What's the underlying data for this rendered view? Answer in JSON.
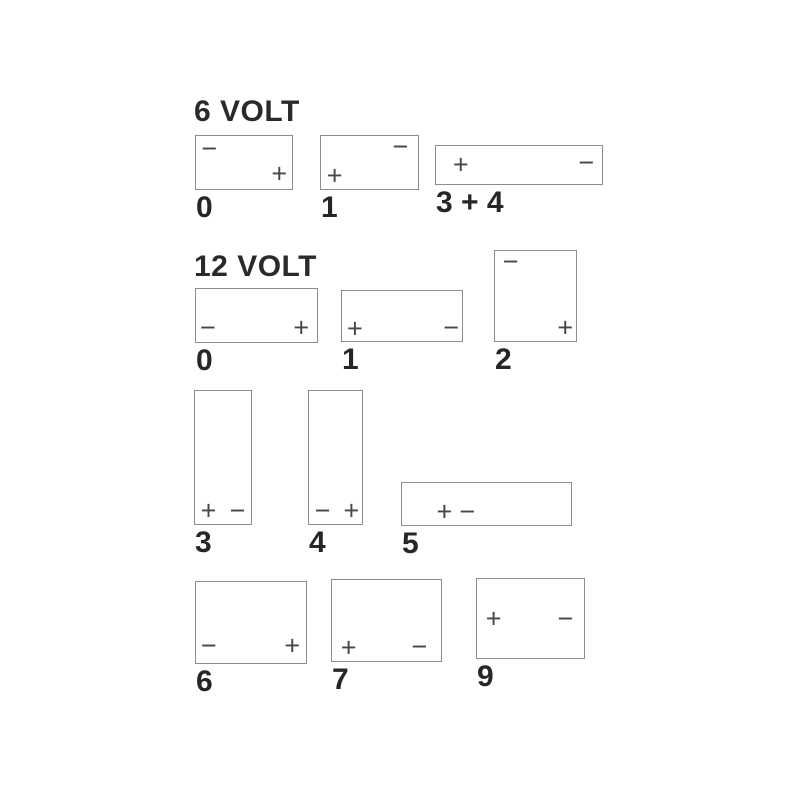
{
  "diagram_title": "Battery terminal layout codes",
  "colors": {
    "background": "#ffffff",
    "box_border": "#8d8d8d",
    "terminal": "#474747",
    "label_text": "#262626"
  },
  "glyphs": {
    "plus": "+",
    "minus": "−"
  },
  "sections": [
    {
      "title": "6 VOLT",
      "title_pos": {
        "x": 194,
        "y": 97
      },
      "batteries": [
        {
          "label": "0",
          "box": {
            "x": 195,
            "y": 135,
            "w": 98,
            "h": 55
          },
          "terminals": [
            {
              "sign": "minus",
              "x_pct": 13.8,
              "y_pct": 23.6
            },
            {
              "sign": "plus",
              "x_pct": 86.7,
              "y_pct": 70.9
            }
          ]
        },
        {
          "label": "1",
          "box": {
            "x": 320,
            "y": 135,
            "w": 99,
            "h": 55
          },
          "terminals": [
            {
              "sign": "minus",
              "x_pct": 81.8,
              "y_pct": 20.0
            },
            {
              "sign": "plus",
              "x_pct": 14.1,
              "y_pct": 76.4
            }
          ]
        },
        {
          "label": "3 + 4",
          "box": {
            "x": 435,
            "y": 145,
            "w": 168,
            "h": 40
          },
          "terminals": [
            {
              "sign": "plus",
              "x_pct": 14.9,
              "y_pct": 50.0
            },
            {
              "sign": "minus",
              "x_pct": 90.5,
              "y_pct": 46.0
            }
          ]
        }
      ]
    },
    {
      "title": "12 VOLT",
      "title_pos": {
        "x": 194,
        "y": 252
      },
      "batteries": [
        {
          "label": "0",
          "box": {
            "x": 195,
            "y": 288,
            "w": 123,
            "h": 55
          },
          "terminals": [
            {
              "sign": "minus",
              "x_pct": 9.8,
              "y_pct": 74.5
            },
            {
              "sign": "plus",
              "x_pct": 87.0,
              "y_pct": 74.5
            }
          ]
        },
        {
          "label": "1",
          "box": {
            "x": 341,
            "y": 290,
            "w": 122,
            "h": 52
          },
          "terminals": [
            {
              "sign": "plus",
              "x_pct": 10.7,
              "y_pct": 75.0
            },
            {
              "sign": "minus",
              "x_pct": 91.0,
              "y_pct": 73.0
            }
          ]
        },
        {
          "label": "2",
          "box": {
            "x": 494,
            "y": 250,
            "w": 83,
            "h": 92
          },
          "terminals": [
            {
              "sign": "minus",
              "x_pct": 19.3,
              "y_pct": 12.0
            },
            {
              "sign": "plus",
              "x_pct": 86.7,
              "y_pct": 85.9
            }
          ]
        },
        {
          "label": "3",
          "box": {
            "x": 194,
            "y": 390,
            "w": 58,
            "h": 135
          },
          "terminals": [
            {
              "sign": "plus",
              "x_pct": 24.1,
              "y_pct": 90.4
            },
            {
              "sign": "minus",
              "x_pct": 75.9,
              "y_pct": 90.4
            }
          ]
        },
        {
          "label": "4",
          "box": {
            "x": 308,
            "y": 390,
            "w": 55,
            "h": 135
          },
          "terminals": [
            {
              "sign": "minus",
              "x_pct": 25.5,
              "y_pct": 90.4
            },
            {
              "sign": "plus",
              "x_pct": 80.0,
              "y_pct": 90.4
            }
          ]
        },
        {
          "label": "5",
          "box": {
            "x": 401,
            "y": 482,
            "w": 171,
            "h": 44
          },
          "terminals": [
            {
              "sign": "plus",
              "x_pct": 25.1,
              "y_pct": 68.0
            },
            {
              "sign": "minus",
              "x_pct": 38.6,
              "y_pct": 68.0
            }
          ]
        },
        {
          "label": "6",
          "box": {
            "x": 195,
            "y": 581,
            "w": 112,
            "h": 83
          },
          "terminals": [
            {
              "sign": "minus",
              "x_pct": 11.6,
              "y_pct": 79.5
            },
            {
              "sign": "plus",
              "x_pct": 87.5,
              "y_pct": 79.5
            }
          ]
        },
        {
          "label": "7",
          "box": {
            "x": 331,
            "y": 579,
            "w": 111,
            "h": 83
          },
          "terminals": [
            {
              "sign": "plus",
              "x_pct": 15.3,
              "y_pct": 84.3
            },
            {
              "sign": "minus",
              "x_pct": 80.2,
              "y_pct": 83.1
            }
          ]
        },
        {
          "label": "9",
          "box": {
            "x": 476,
            "y": 578,
            "w": 109,
            "h": 81
          },
          "terminals": [
            {
              "sign": "plus",
              "x_pct": 15.6,
              "y_pct": 50.6
            },
            {
              "sign": "minus",
              "x_pct": 82.6,
              "y_pct": 50.6
            }
          ]
        }
      ]
    }
  ]
}
